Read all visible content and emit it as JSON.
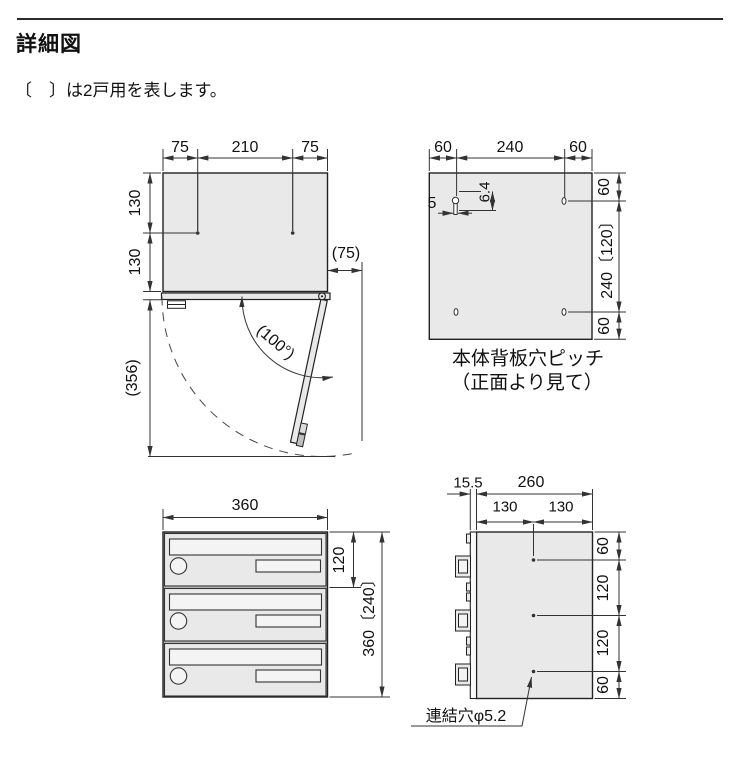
{
  "header": {
    "title": "詳細図",
    "note": "〔　〕は2戸用を表します。"
  },
  "top_view": {
    "dim_top_left": "75",
    "dim_top_center": "210",
    "dim_top_right": "75",
    "dim_left_upper": "130",
    "dim_left_lower": "130",
    "dim_door_offset": "(75)",
    "dim_open_angle": "(100°)",
    "dim_open_depth": "(356)"
  },
  "back_panel": {
    "dim_top_left": "60",
    "dim_top_center": "240",
    "dim_top_right": "60",
    "dim_slot_width": "5",
    "dim_slot_height": "6.4",
    "dim_right_top": "60",
    "dim_right_center": "240〔120〕",
    "dim_right_bottom": "60",
    "caption_line1": "本体背板穴ピッチ",
    "caption_line2": "（正面より見て）"
  },
  "front_view": {
    "dim_width": "360",
    "dim_unit_height": "120",
    "dim_total_height": "360〔240〕"
  },
  "side_view": {
    "dim_door_thickness": "15.5",
    "dim_depth": "260",
    "dim_half_left": "130",
    "dim_half_right": "130",
    "dim_right_top": "60",
    "dim_right_upper": "120",
    "dim_right_lower": "120",
    "dim_right_bottom": "60",
    "hole_label": "連結穴φ5.2"
  }
}
